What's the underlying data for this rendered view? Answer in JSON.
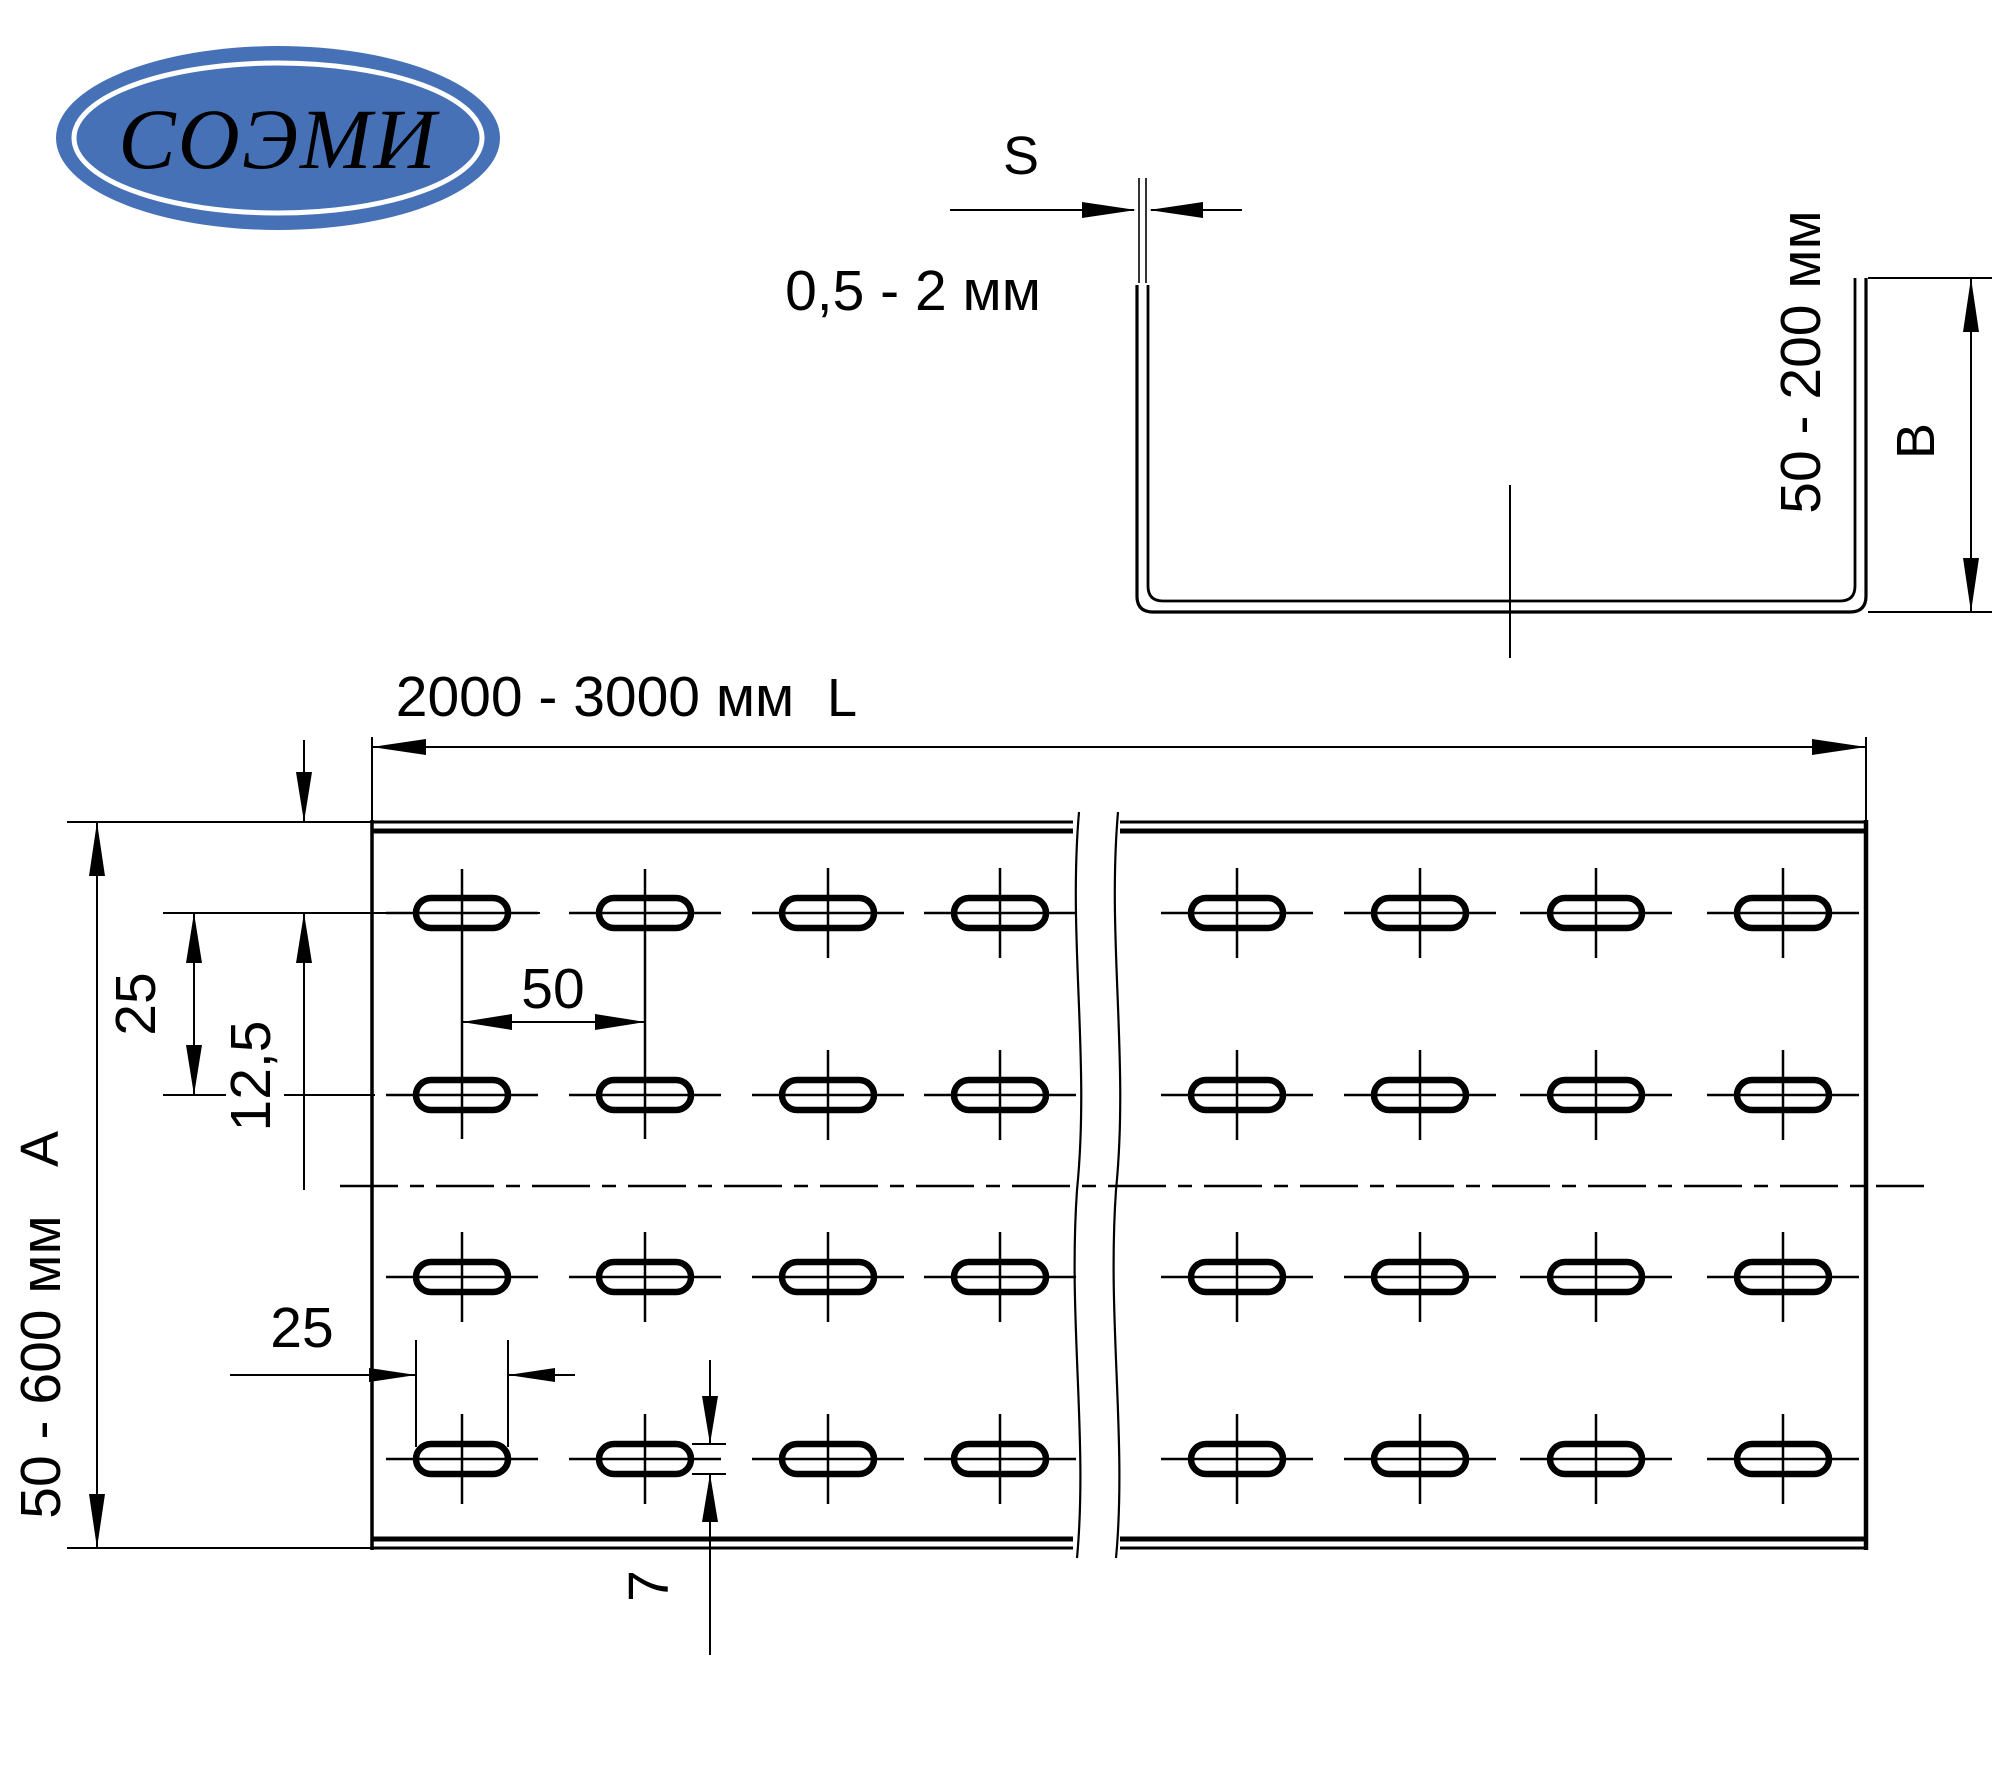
{
  "page": {
    "background": "#ffffff",
    "line_color": "#000000"
  },
  "logo": {
    "text": "СОЭМИ",
    "bg_color": "#4671b6",
    "ring_color": "#ffffff",
    "text_color": "#ffffff"
  },
  "profile": {
    "s_label": "S",
    "thickness_range": "0,5 - 2 мм",
    "height_range": "50 - 200 мм",
    "height_letter": "B"
  },
  "plan": {
    "length_range": "2000 - 3000 мм",
    "length_letter": "L",
    "width_range": "50 - 600 мм",
    "width_letter": "A",
    "dim_row_spacing": "25",
    "dim_edge_offset": "12,5",
    "dim_pitch": "50",
    "dim_slot_length": "25",
    "dim_slot_width": "7"
  }
}
